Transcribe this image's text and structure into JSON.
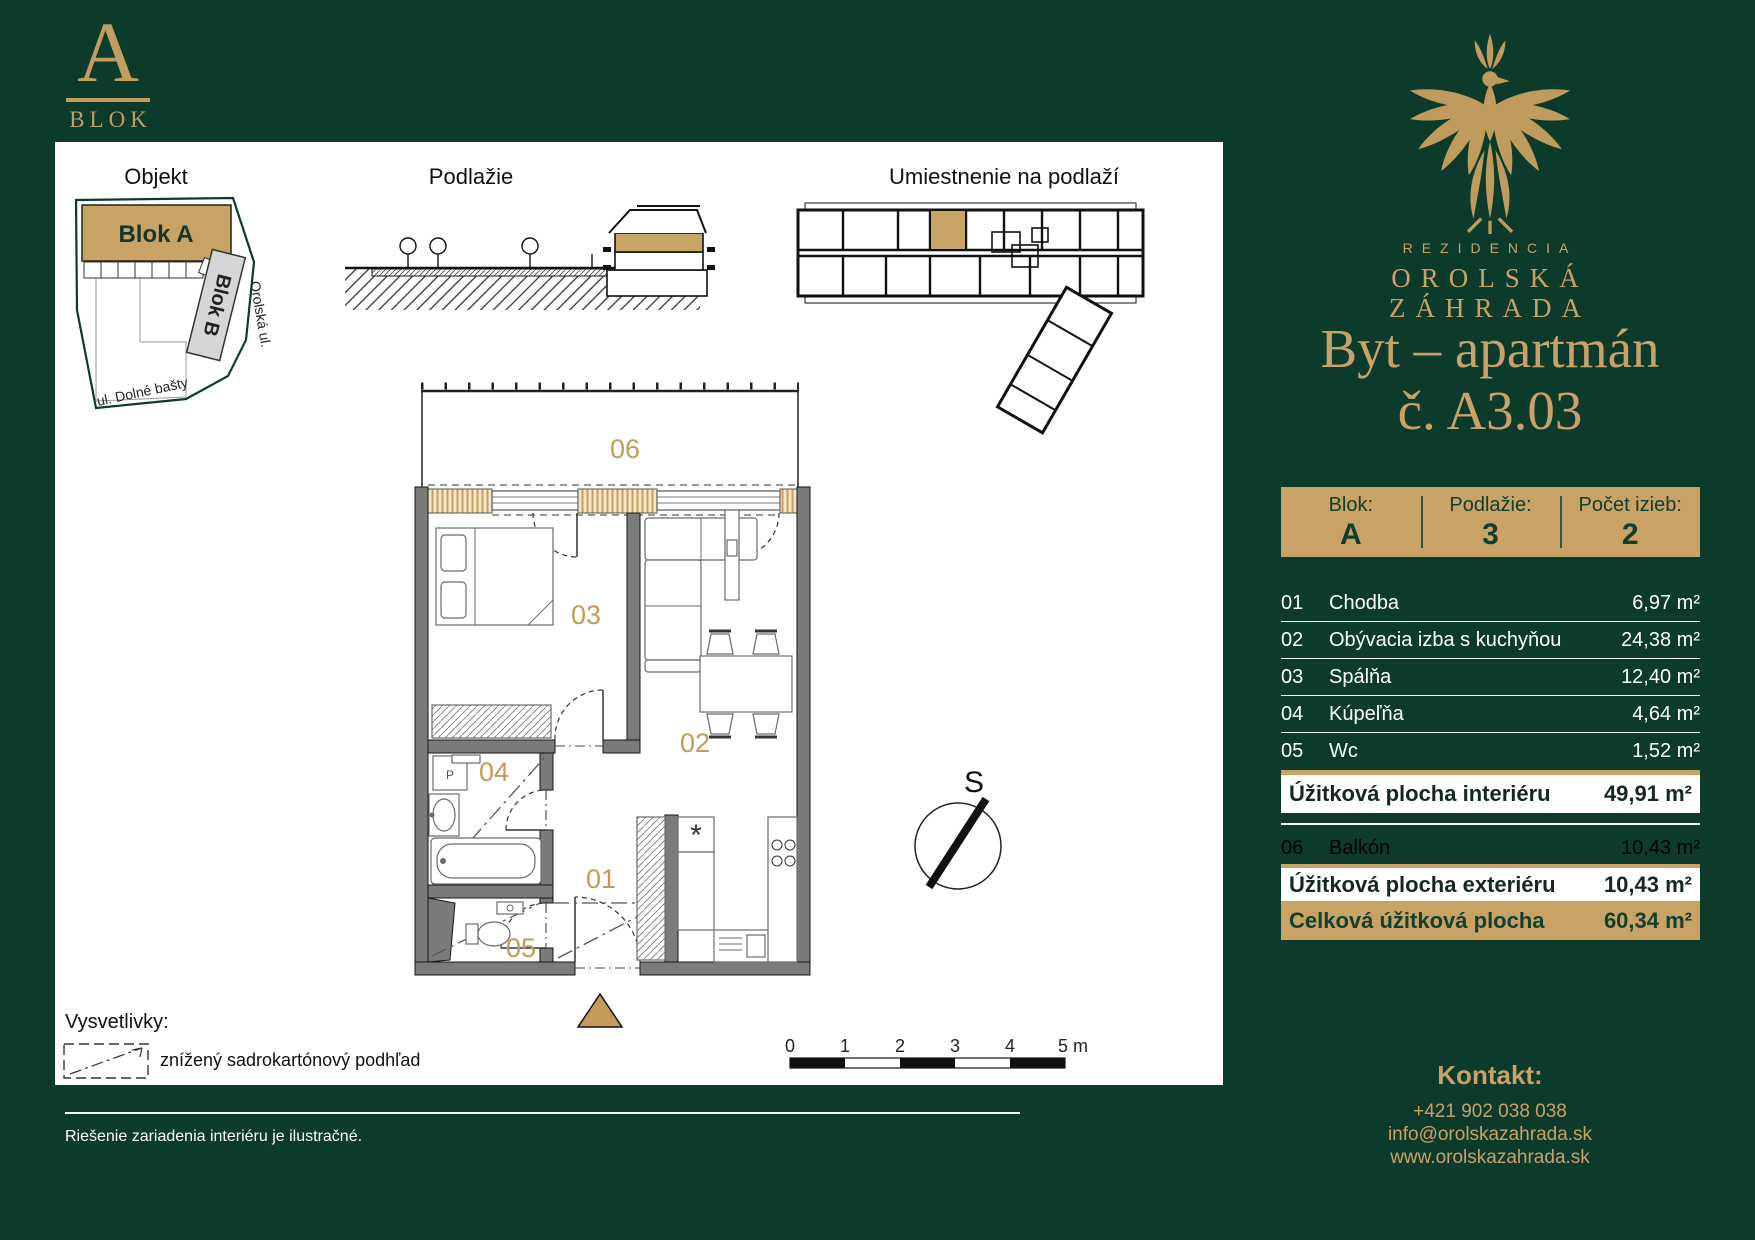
{
  "logo": {
    "letter": "A",
    "text": "BLOK"
  },
  "diagrams": {
    "objekt": {
      "title": "Objekt",
      "blok_a": "Blok A",
      "blok_b": "Blok B",
      "street_right": "Orolská ul.",
      "street_bottom": "ul. Dolné bašty"
    },
    "podlazie": {
      "title": "Podlažie"
    },
    "umiestnenie": {
      "title": "Umiestnenie na podlaží"
    }
  },
  "floorplan": {
    "room_labels": {
      "balcony": "06",
      "bedroom": "03",
      "living": "02",
      "bathroom": "04",
      "hallway": "01",
      "wc": "05"
    },
    "washer_label": "P",
    "boiler_symbol": "*"
  },
  "compass": {
    "north_label": "S"
  },
  "scalebar": {
    "ticks": [
      "0",
      "1",
      "2",
      "3",
      "4",
      "5 m"
    ]
  },
  "legend": {
    "heading": "Vysvetlivky:",
    "item": "znížený sadrokartónový podhľad"
  },
  "footnote": "Riešenie zariadenia interiéru je ilustračné.",
  "brand": {
    "line1": "REZIDENCIA",
    "line2": "OROLSKÁ",
    "line3": "ZÁHRADA"
  },
  "title": {
    "line1": "Byt – apartmán",
    "line2": "č. A3.03"
  },
  "info_bar": {
    "cells": [
      {
        "label": "Blok:",
        "value": "A"
      },
      {
        "label": "Podlažie:",
        "value": "3"
      },
      {
        "label": "Počet izieb:",
        "value": "2"
      }
    ]
  },
  "rooms": [
    {
      "num": "01",
      "name": "Chodba",
      "area": "6,97 m²"
    },
    {
      "num": "02",
      "name": "Obývacia izba s kuchyňou",
      "area": "24,38 m²"
    },
    {
      "num": "03",
      "name": "Spálňa",
      "area": "12,40 m²"
    },
    {
      "num": "04",
      "name": "Kúpeľňa",
      "area": "4,64 m²"
    },
    {
      "num": "05",
      "name": "Wc",
      "area": "1,52 m²"
    }
  ],
  "totals": {
    "interior": {
      "label": "Úžitková plocha interiéru",
      "value": "49,91 m²"
    },
    "balcony_row": {
      "num": "06",
      "name": "Balkón",
      "area": "10,43 m²"
    },
    "exterior": {
      "label": "Úžitková plocha exteriéru",
      "value": "10,43 m²"
    },
    "total": {
      "label": "Celková úžitková plocha",
      "value": "60,34 m²"
    }
  },
  "contact": {
    "heading": "Kontakt:",
    "phone": "+421 902 038 038",
    "email": "info@orolskazahrada.sk",
    "web": "www.orolskazahrada.sk"
  },
  "colors": {
    "green": "#0d3b2b",
    "gold": "#c9a365",
    "gold_text": "#c9a26a",
    "plan_gold": "#c49a58"
  }
}
